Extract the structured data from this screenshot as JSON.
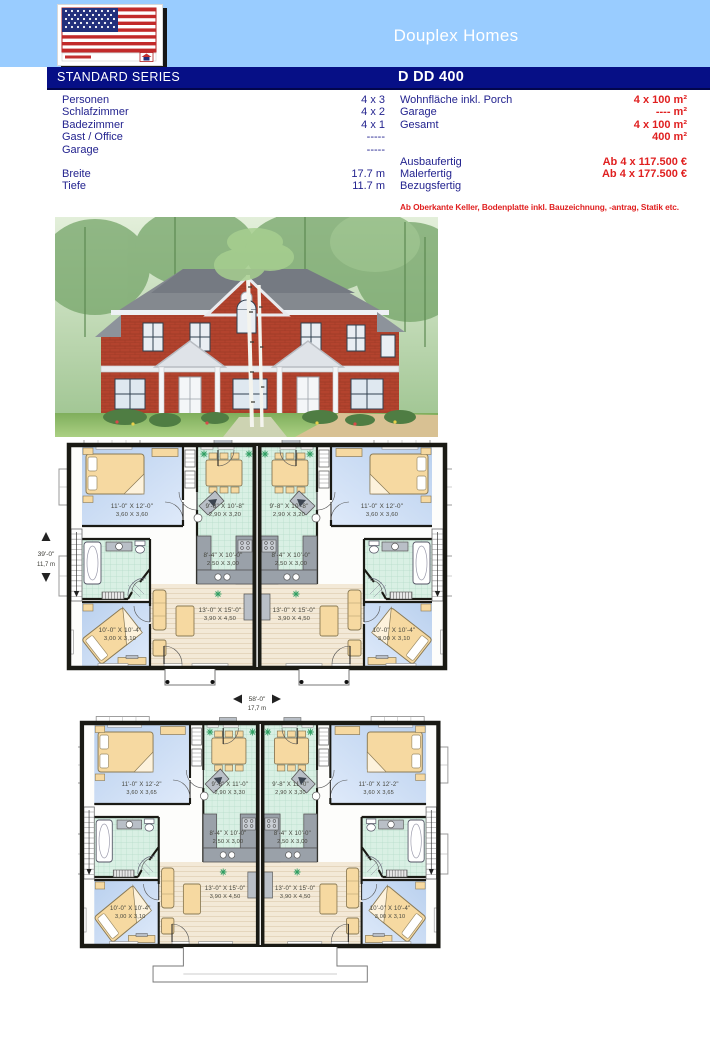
{
  "header": {
    "title": "Douplex Homes",
    "series_label": "STANDARD SERIES",
    "model_code": "D DD 400",
    "logo": "us-flag-american-homes-logo",
    "colors": {
      "band": "#99ccff",
      "bar": "#060f86",
      "title_text": "#ffffff"
    }
  },
  "specs": {
    "left": [
      {
        "label": "Personen",
        "value": "4 x 3"
      },
      {
        "label": "Schlafzimmer",
        "value": "4 x 2"
      },
      {
        "label": "Badezimmer",
        "value": "4 x 1"
      },
      {
        "label": "Gast / Office",
        "value": "-----"
      },
      {
        "label": "Garage",
        "value": "-----"
      },
      {
        "label": "Breite",
        "value": "17.7 m"
      },
      {
        "label": "Tiefe",
        "value": "11.7 m"
      }
    ],
    "right": [
      {
        "label": "Wohnfläche inkl. Porch",
        "value": "4 x 100 m²"
      },
      {
        "label": "Garage",
        "value": "---- m²"
      },
      {
        "label": "Gesamt",
        "value": "4 x 100 m²"
      },
      {
        "label": "",
        "value": "400 m²"
      },
      {
        "label": "Ausbaufertig",
        "value": "Ab 4 x 117.500 €"
      },
      {
        "label": "Malerfertig",
        "value": "Ab 4 x 177.500 €"
      },
      {
        "label": "Bezugsfertig",
        "value": ""
      }
    ],
    "note": "Ab Oberkante Keller, Bodenplatte inkl. Bauzeichnung, -antrag, Statik etc.",
    "value_color": "#e02020",
    "label_color": "#23238f"
  },
  "floorplan1": {
    "rooms": {
      "bedroom_rear": {
        "imp": "11'-0\" X 12'-0\"",
        "met": "3,60 X 3,60"
      },
      "dining": {
        "imp": "9'-8\" X 10'-8\"",
        "met": "2,90 X 3,20"
      },
      "kitchen": {
        "imp": "8'-4\" X 10'-0\"",
        "met": "2,50 X 3,00"
      },
      "living": {
        "imp": "13'-0\" X 15'-0\"",
        "met": "3,90 X 4,50"
      },
      "bedroom_front": {
        "imp": "10'-0\" X 10'-4\"",
        "met": "3,00 X 3,10"
      }
    },
    "width_dim": {
      "imp": "58'-0\"",
      "met": "17,7 m"
    },
    "depth_dim": {
      "imp": "39'-0\"",
      "met": "11,7 m"
    }
  },
  "floorplan2": {
    "rooms": {
      "bedroom_rear": {
        "imp": "11'-0\" X 12'-2\"",
        "met": "3,60 X 3,65"
      },
      "dining": {
        "imp": "9'-8\" X 11'-0\"",
        "met": "2,90 X 3,30"
      },
      "kitchen": {
        "imp": "8'-4\" X 10'-0\"",
        "met": "2,50 X 3,00"
      },
      "living": {
        "imp": "13'-0\" X 15'-0\"",
        "met": "3,90 X 4,50"
      },
      "bedroom_front": {
        "imp": "10'-0\" X 10'-4\"",
        "met": "3,00 X 3,10"
      }
    }
  }
}
